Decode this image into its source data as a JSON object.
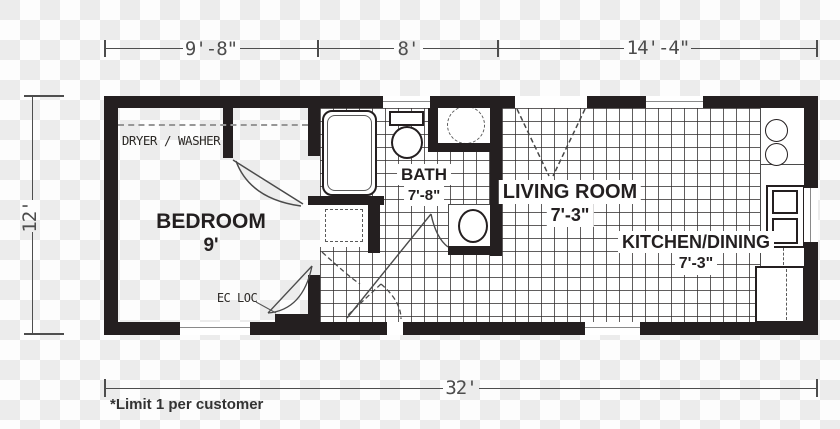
{
  "title": "single-section floor plan",
  "colors": {
    "wall": "#241f20",
    "dimension_line": "#4d4d4d",
    "label_text": "#231f20",
    "tile_line": "#343030",
    "checker_light": "#fdfdfd",
    "checker_dark": "#ececec"
  },
  "dimensions": {
    "top_left": "9'-8\"",
    "top_middle": "8'",
    "top_right": "14'-4\"",
    "left": "12'",
    "bottom": "32'"
  },
  "rooms": {
    "bedroom": {
      "name": "BEDROOM",
      "size": "9'"
    },
    "bath": {
      "name": "BATH",
      "size": "7'-8\""
    },
    "living": {
      "name": "LIVING ROOM",
      "size": "7'-3\""
    },
    "kitchen": {
      "name": "KITCHEN/DINING",
      "size": "7'-3\""
    }
  },
  "labels": {
    "dryer_washer": "DRYER / WASHER",
    "ec_loc": "EC LOC",
    "footnote": "*Limit 1 per customer"
  },
  "fixtures": [
    "bathtub",
    "toilet",
    "water-heater",
    "vanity-sink",
    "kitchen-sink",
    "stove",
    "refrigerator",
    "bath-closet",
    "kitchen-counter"
  ]
}
